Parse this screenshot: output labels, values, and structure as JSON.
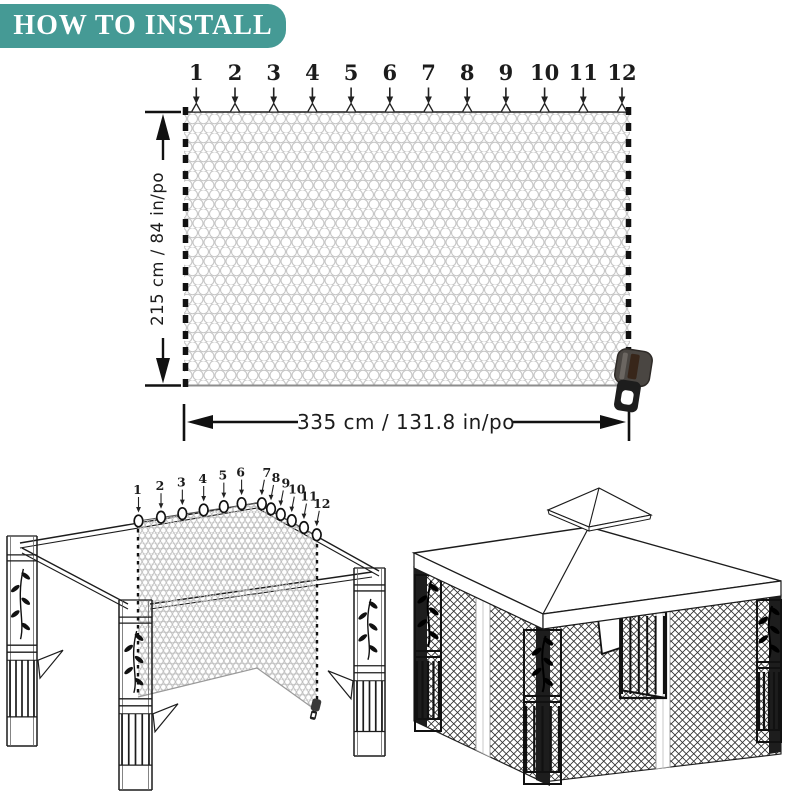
{
  "header": {
    "title": "HOW TO INSTALL"
  },
  "colors": {
    "banner": "#459a95",
    "banner_text": "#ffffff",
    "line": "#1c1c1c",
    "mesh_gray": "#c6c6c6"
  },
  "net_diagram": {
    "clip_numbers": [
      "1",
      "2",
      "3",
      "4",
      "5",
      "6",
      "7",
      "8",
      "9",
      "10",
      "11",
      "12"
    ],
    "height_label": "215 cm /  84  in/po",
    "width_label": "335 cm / 131.8 in/po"
  },
  "install_diagram": {
    "clip_numbers": [
      "1",
      "2",
      "3",
      "4",
      "5",
      "6",
      "7",
      "8",
      "9",
      "10",
      "11",
      "12"
    ]
  }
}
